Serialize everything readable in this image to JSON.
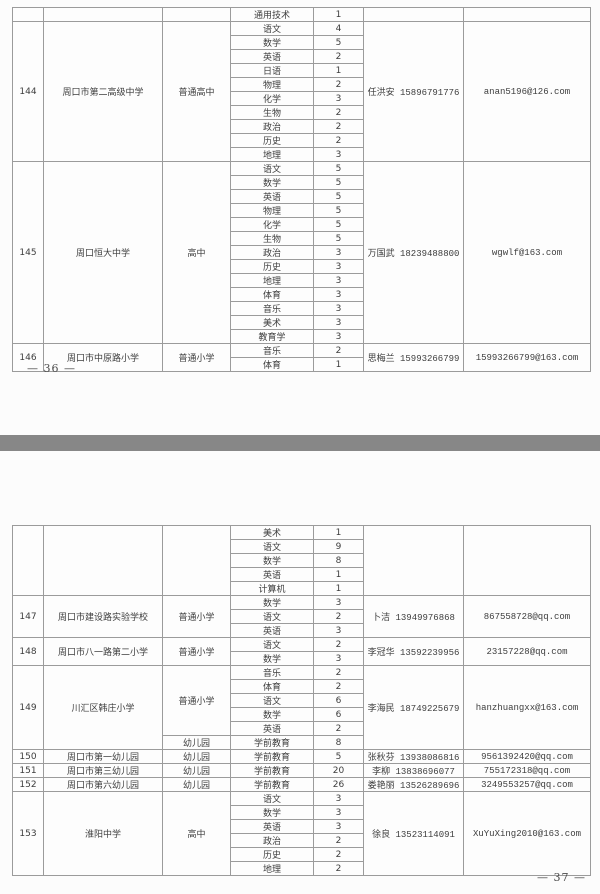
{
  "document": {
    "kind": "scanned recruitment plan table, two pages",
    "colors": {
      "divider": "#878787",
      "table_border": "#9b9b9b",
      "text": "#3d3d3d",
      "page_bg": "#fcfcfc"
    }
  },
  "pages": [
    {
      "page_number": "— 36 —",
      "blocks": [
        {
          "num": "",
          "school": "",
          "types": [
            {
              "label": "",
              "span": 1
            }
          ],
          "subjects": [
            {
              "name": "通用技术",
              "count": "1"
            }
          ],
          "contact": "",
          "email": ""
        },
        {
          "num": "144",
          "school": "周口市第二高级中学",
          "types": [
            {
              "label": "普通高中",
              "span": 10
            }
          ],
          "subjects": [
            {
              "name": "语文",
              "count": "4"
            },
            {
              "name": "数学",
              "count": "5"
            },
            {
              "name": "英语",
              "count": "2"
            },
            {
              "name": "日语",
              "count": "1"
            },
            {
              "name": "物理",
              "count": "2"
            },
            {
              "name": "化学",
              "count": "3"
            },
            {
              "name": "生物",
              "count": "2"
            },
            {
              "name": "政治",
              "count": "2"
            },
            {
              "name": "历史",
              "count": "2"
            },
            {
              "name": "地理",
              "count": "3"
            }
          ],
          "contact": "任洪安 15896791776",
          "email": "anan5196@126.com"
        },
        {
          "num": "145",
          "school": "周口恒大中学",
          "types": [
            {
              "label": "高中",
              "span": 13
            }
          ],
          "subjects": [
            {
              "name": "语文",
              "count": "5"
            },
            {
              "name": "数学",
              "count": "5"
            },
            {
              "name": "英语",
              "count": "5"
            },
            {
              "name": "物理",
              "count": "5"
            },
            {
              "name": "化学",
              "count": "5"
            },
            {
              "name": "生物",
              "count": "5"
            },
            {
              "name": "政治",
              "count": "3"
            },
            {
              "name": "历史",
              "count": "3"
            },
            {
              "name": "地理",
              "count": "3"
            },
            {
              "name": "体育",
              "count": "3"
            },
            {
              "name": "音乐",
              "count": "3"
            },
            {
              "name": "美术",
              "count": "3"
            },
            {
              "name": "教育学",
              "count": "3"
            }
          ],
          "contact": "万国武 18239488800",
          "email": "wgwlf@163.com"
        },
        {
          "num": "146",
          "school": "周口市中原路小学",
          "types": [
            {
              "label": "普通小学",
              "span": 2
            }
          ],
          "subjects": [
            {
              "name": "音乐",
              "count": "2"
            },
            {
              "name": "体育",
              "count": "1"
            }
          ],
          "contact": "思梅兰 15993266799",
          "email": "15993266799@163.com"
        }
      ]
    },
    {
      "page_number": "— 37 —",
      "blocks": [
        {
          "num": "",
          "school": "",
          "types": [
            {
              "label": "",
              "span": 5
            }
          ],
          "subjects": [
            {
              "name": "美术",
              "count": "1"
            },
            {
              "name": "语文",
              "count": "9"
            },
            {
              "name": "数学",
              "count": "8"
            },
            {
              "name": "英语",
              "count": "1"
            },
            {
              "name": "计算机",
              "count": "1"
            }
          ],
          "contact": "",
          "email": ""
        },
        {
          "num": "147",
          "school": "周口市建设路实验学校",
          "types": [
            {
              "label": "普通小学",
              "span": 3
            }
          ],
          "subjects": [
            {
              "name": "数学",
              "count": "3"
            },
            {
              "name": "语文",
              "count": "2"
            },
            {
              "name": "英语",
              "count": "3"
            }
          ],
          "contact": "卜洁 13949976868",
          "email": "867558728@qq.com"
        },
        {
          "num": "148",
          "school": "周口市八一路第二小学",
          "types": [
            {
              "label": "普通小学",
              "span": 2
            }
          ],
          "subjects": [
            {
              "name": "语文",
              "count": "2"
            },
            {
              "name": "数学",
              "count": "3"
            }
          ],
          "contact": "李冠华 13592239956",
          "email": "23157228@qq.com"
        },
        {
          "num": "149",
          "school": "川汇区韩庄小学",
          "types": [
            {
              "label": "普通小学",
              "span": 5
            },
            {
              "label": "幼儿园",
              "span": 1
            }
          ],
          "subjects": [
            {
              "name": "音乐",
              "count": "2"
            },
            {
              "name": "体育",
              "count": "2"
            },
            {
              "name": "语文",
              "count": "6"
            },
            {
              "name": "数学",
              "count": "6"
            },
            {
              "name": "英语",
              "count": "2"
            },
            {
              "name": "学前教育",
              "count": "8"
            }
          ],
          "contact": "李海民 18749225679",
          "email": "hanzhuangxx@163.com"
        },
        {
          "num": "150",
          "school": "周口市第一幼儿园",
          "types": [
            {
              "label": "幼儿园",
              "span": 1
            }
          ],
          "subjects": [
            {
              "name": "学前教育",
              "count": "5"
            }
          ],
          "contact": "张秋芬 13938086816",
          "email": "9561392420@qq.com"
        },
        {
          "num": "151",
          "school": "周口市第三幼儿园",
          "types": [
            {
              "label": "幼儿园",
              "span": 1
            }
          ],
          "subjects": [
            {
              "name": "学前教育",
              "count": "20"
            }
          ],
          "contact": "李柳 13838696077",
          "email": "755172318@qq.com"
        },
        {
          "num": "152",
          "school": "周口市第六幼儿园",
          "types": [
            {
              "label": "幼儿园",
              "span": 1
            }
          ],
          "subjects": [
            {
              "name": "学前教育",
              "count": "26"
            }
          ],
          "contact": "娄艳丽 13526289696",
          "email": "3249553257@qq.com"
        },
        {
          "num": "153",
          "school": "淮阳中学",
          "types": [
            {
              "label": "高中",
              "span": 6
            }
          ],
          "subjects": [
            {
              "name": "语文",
              "count": "3"
            },
            {
              "name": "数学",
              "count": "3"
            },
            {
              "name": "英语",
              "count": "3"
            },
            {
              "name": "政治",
              "count": "2"
            },
            {
              "name": "历史",
              "count": "2"
            },
            {
              "name": "地理",
              "count": "2"
            }
          ],
          "contact": "徐良 13523114091",
          "email": "XuYuXing2010@163.com"
        }
      ]
    }
  ]
}
